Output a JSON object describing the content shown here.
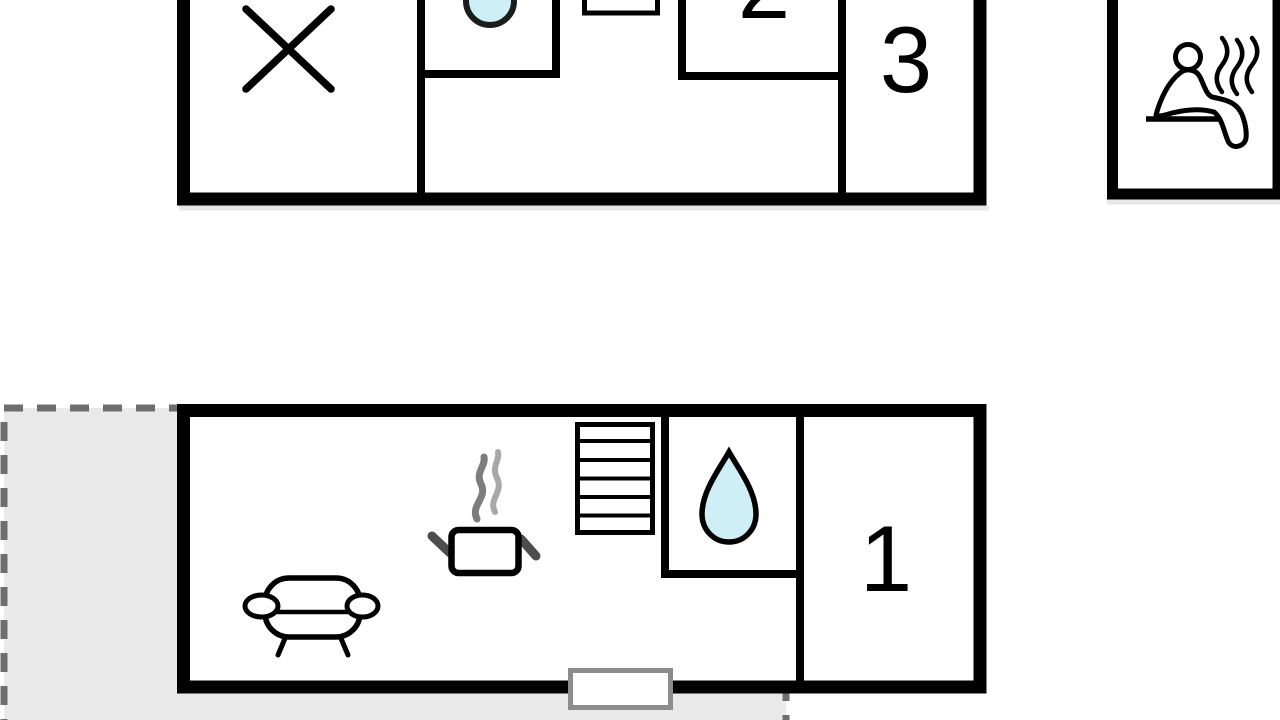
{
  "floor_plan": {
    "upper_floor": {
      "room_labels": {
        "room2": "2",
        "room3": "3"
      },
      "icons": [
        "cross-marker-icon",
        "washbasin-icon",
        "window-marker"
      ]
    },
    "sauna_cabin": {
      "icons": [
        "sauna-person-icon",
        "steam-icon"
      ]
    },
    "ground_floor": {
      "room_labels": {
        "room1": "1"
      },
      "icons": [
        "sofa-icon",
        "cooking-pot-icon",
        "steam-icon",
        "stairs-icon",
        "water-droplet-icon",
        "entrance-door-marker",
        "terrace-area"
      ]
    }
  },
  "colors": {
    "wall": "#000000",
    "water": "#cdeff5",
    "basin_outline": "#1c1c1c",
    "terrace_fill": "#e9e9e9",
    "terrace_dash": "#6e6e6e",
    "door_border": "#8c8c8c",
    "steam_dark": "#7d7d7d",
    "steam_light": "#a8a8a8",
    "pot_handle": "#4d4d4d",
    "shadow": "#d8d8d8"
  }
}
